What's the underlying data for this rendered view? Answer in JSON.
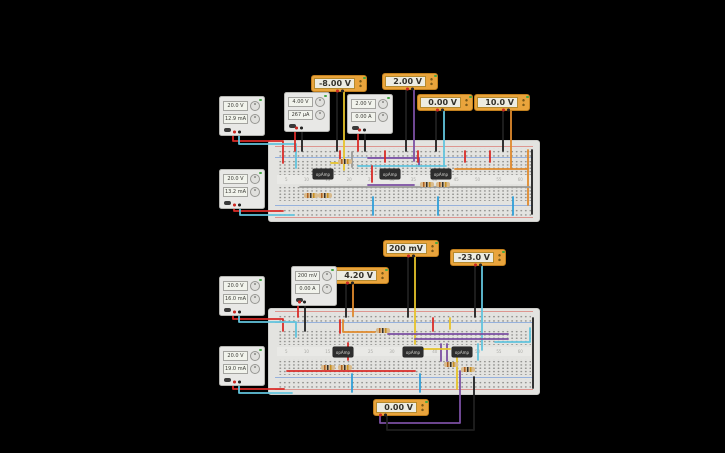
{
  "app": {
    "background": "#000000",
    "workspace": "circuit-simulator-canvas"
  },
  "palette": {
    "meter_frame": "#e9a43c",
    "meter_frame_border": "#c2801e",
    "meter_face": "#edece2",
    "meter_text": "#33312a",
    "psu_body": "#e8e8e6",
    "psu_border": "#b5b5b1",
    "psu_display_face": "#f1f3ec",
    "psu_display_text": "#3a3a35",
    "led_green": "#45a845",
    "breadboard_face": "#e3e3e0",
    "breadboard_border": "#cdcdca",
    "breadboard_hole": "#8e8e8b",
    "chip_body": "#2d2d2d",
    "chip_text": "#d8d8d4",
    "resistor_body": "#d9bb8d",
    "rail_red": "#d84a40",
    "rail_blue": "#4a7fd8",
    "wire": {
      "red": "#d92b27",
      "blue": "#2f9fd8",
      "cyan": "#62c4dd",
      "yellow": "#e6c32b",
      "orange": "#e08a2c",
      "purple": "#7b4fa2",
      "black": "#1f1f1f",
      "gray": "#9b9b98",
      "green": "#3f9b42"
    }
  },
  "breadboard": {
    "column_labels": [
      "5",
      "10",
      "15",
      "20",
      "25",
      "30",
      "35",
      "40",
      "45",
      "50",
      "55",
      "60"
    ]
  },
  "parts": {
    "opamp_label": "opAmp"
  },
  "instruments": {
    "multimeters": [
      {
        "id": "multimeter-1",
        "value": "-8.00 V"
      },
      {
        "id": "multimeter-2",
        "value": "2.00 V"
      },
      {
        "id": "multimeter-3",
        "value": "0.00 V"
      },
      {
        "id": "multimeter-4",
        "value": "10.0 V"
      },
      {
        "id": "multimeter-5",
        "value": "4.20 V"
      },
      {
        "id": "multimeter-6",
        "value": "200 mV"
      },
      {
        "id": "multimeter-7",
        "value": "-23.0 V"
      },
      {
        "id": "multimeter-8",
        "value": "0.00 V"
      }
    ],
    "power_supplies": [
      {
        "id": "power-supply-1",
        "voltage": "20.0 V",
        "current": "12.9 mA"
      },
      {
        "id": "power-supply-2",
        "voltage": "4.00 V",
        "current": "267 µA"
      },
      {
        "id": "power-supply-3",
        "voltage": "2.00 V",
        "current": "0.00 A"
      },
      {
        "id": "power-supply-4",
        "voltage": "20.0 V",
        "current": "13.2 mA"
      },
      {
        "id": "power-supply-5",
        "voltage": "20.0 V",
        "current": "16.0 mA"
      },
      {
        "id": "power-supply-6",
        "voltage": "200 mV",
        "current": "0.00 A"
      },
      {
        "id": "power-supply-7",
        "voltage": "20.0 V",
        "current": "19.0 mA"
      }
    ]
  }
}
